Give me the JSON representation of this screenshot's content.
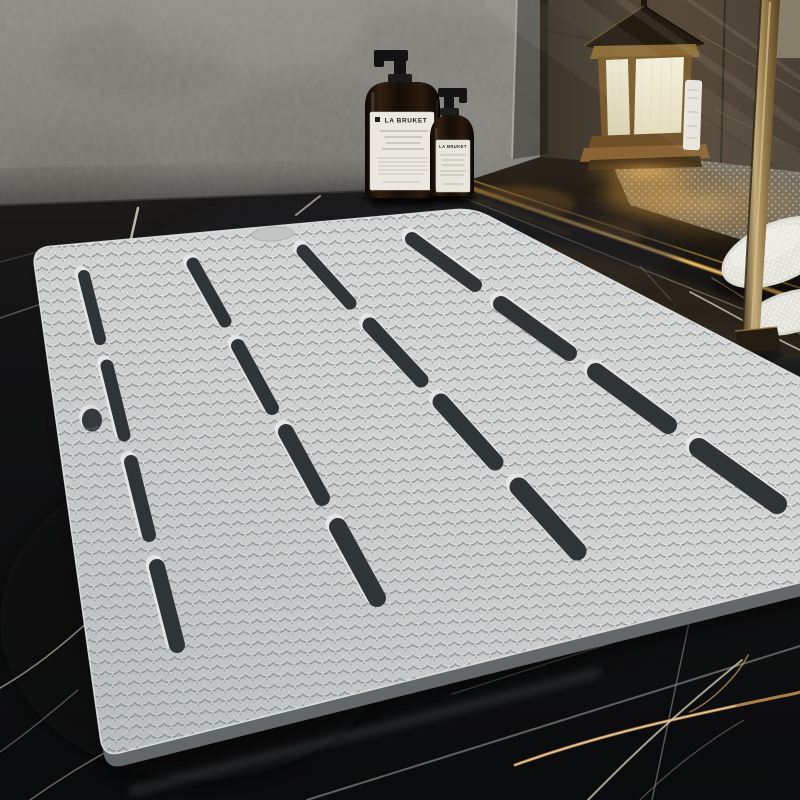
{
  "meta": {
    "description": "Product photo: grey anti-slip bath shower mat with fish-scale texture and drainage slots lying on black marble bathroom floor, beside a glass shower enclosure with a brass lantern, two LA BRUKET amber pump bottles and white terry slippers"
  },
  "product": {
    "name": "anti-slip bath mat",
    "surface_texture": "fish-scale",
    "color": "#d6d8d7",
    "edge_color": "#676c6e",
    "drain_slots": 16,
    "drain_slot_columns": 4,
    "drain_slot_rows": 4,
    "hanging_hole": true,
    "handle_indent": true
  },
  "props": {
    "bottle_large": {
      "brand": "LA BRUKET",
      "type": "amber glass pump bottle",
      "glass_color": "#1f1510",
      "label_color": "#eae8e0"
    },
    "bottle_small": {
      "brand": "LA BRUKET",
      "type": "amber glass pump bottle",
      "glass_color": "#1f1510",
      "label_color": "#e7e5dc"
    },
    "lantern": {
      "style": "brass candle lantern",
      "glass_color": "#efeadc",
      "metal_color": "#8a6a33"
    },
    "slippers": {
      "color": "#e9e8e2",
      "texture": "terry dots"
    },
    "shower_frame_color": "#a98e58",
    "threshold_strip_color": "#f0cf85"
  },
  "environment": {
    "wall": "grey concrete plaster",
    "wall_color": "#87867f",
    "floor": "black marble tiles with gold and white veins",
    "floor_color": "#101112",
    "vein_gold": "#c9a06a",
    "vein_white": "#d8d4c8",
    "lantern_glow": "#ffc668"
  }
}
